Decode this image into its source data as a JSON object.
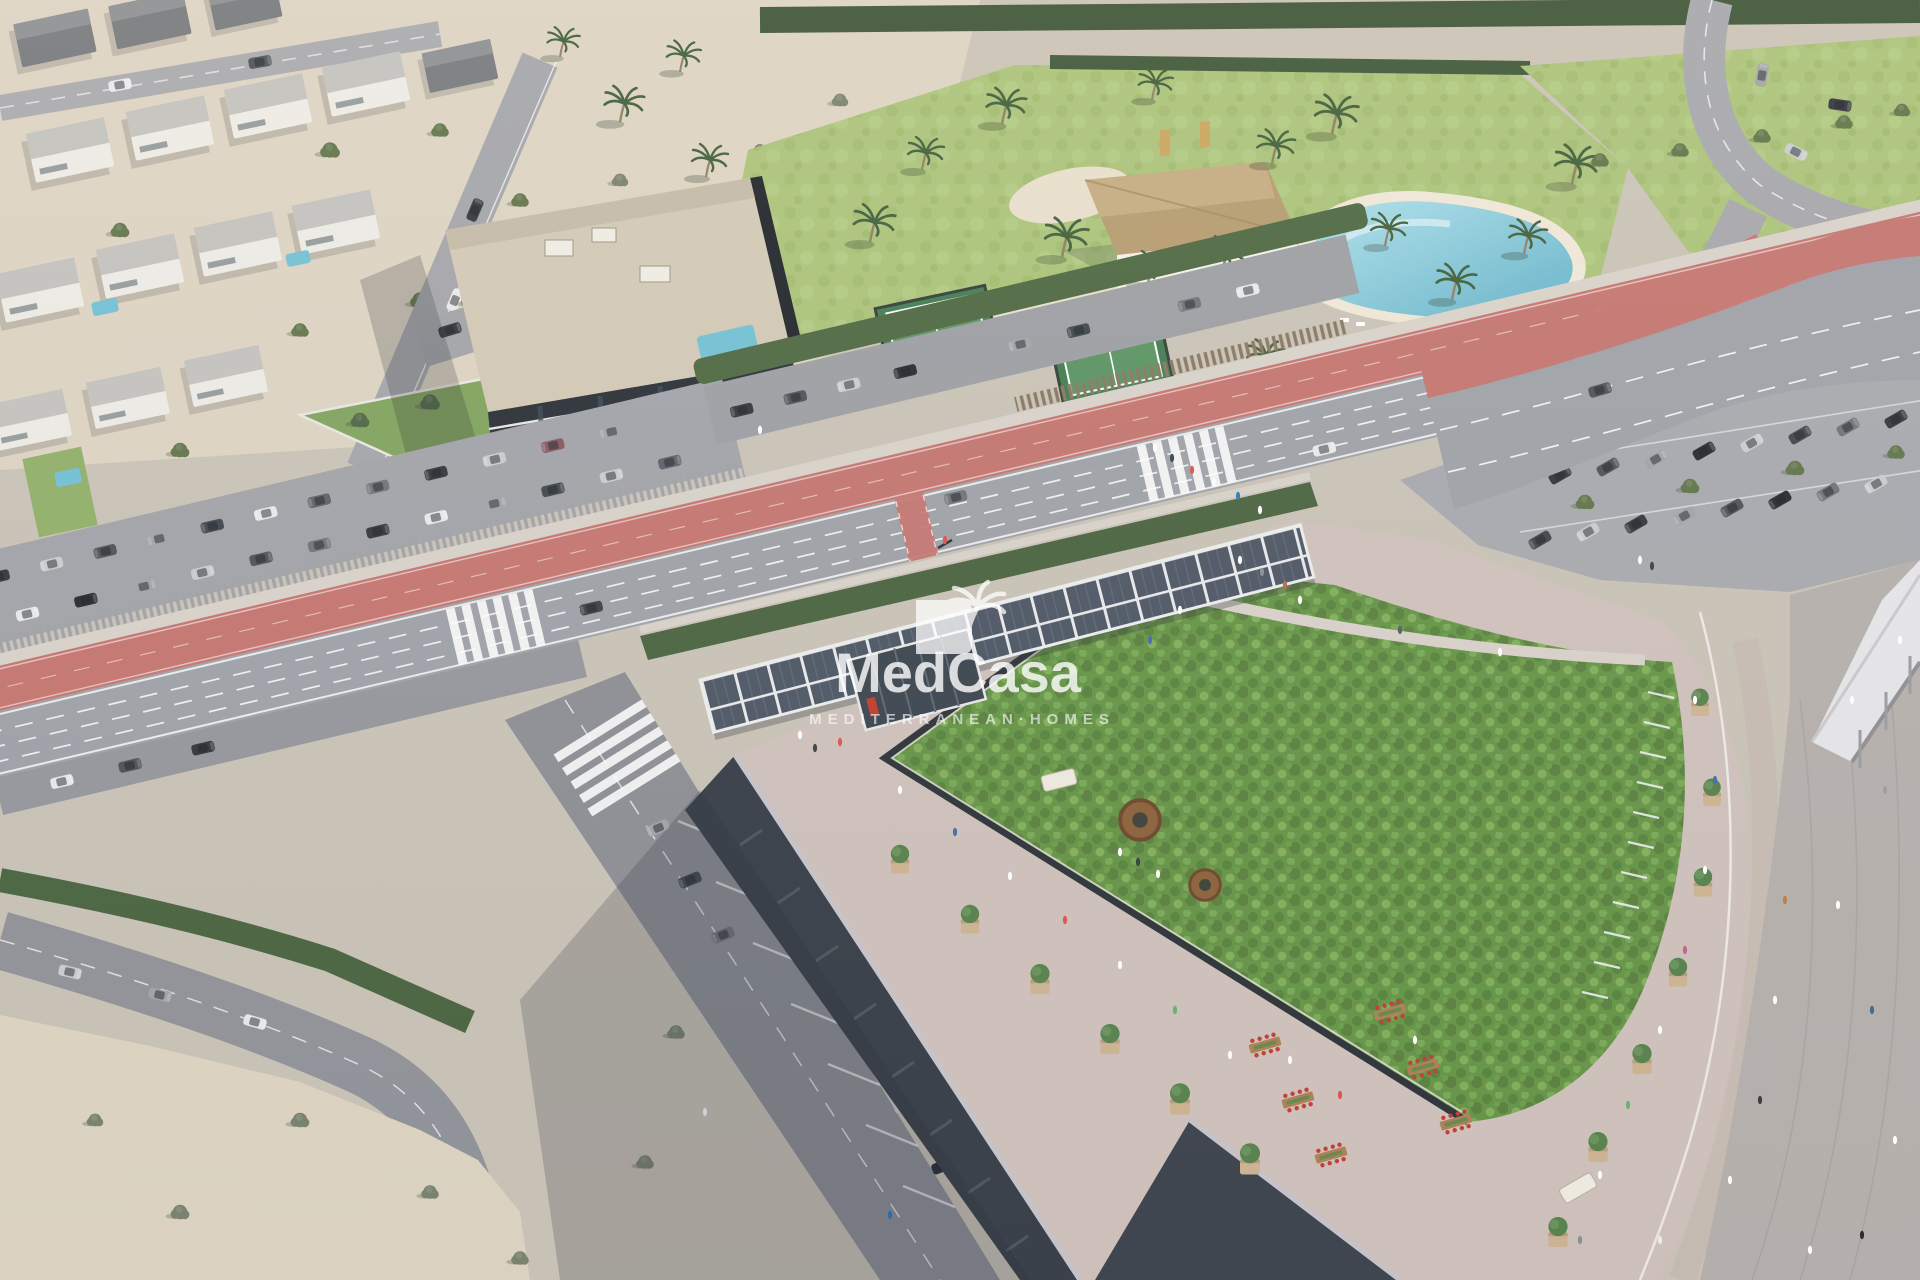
{
  "watermark": {
    "logo": "palm-tree-logo",
    "brand": "MedCasa",
    "tagline": "MEDITERRANEAN·HOMES",
    "text_color": "#ffffff"
  },
  "palette": {
    "road": "#9da0a6",
    "bike_lane_red": "#c4736d",
    "sand_lot": "#ddd3c0",
    "terrace_pavement": "#cfc0ba",
    "green_roof": "#639343",
    "lawn": "#a9c277",
    "pool_water": "#7fc4d8",
    "hedge": "#47613c",
    "building_dark": "#343b44",
    "thatch_roof": "#b59a6d",
    "solar_panel": "#4a5461",
    "apartment_roof": "#d2c8b5"
  }
}
